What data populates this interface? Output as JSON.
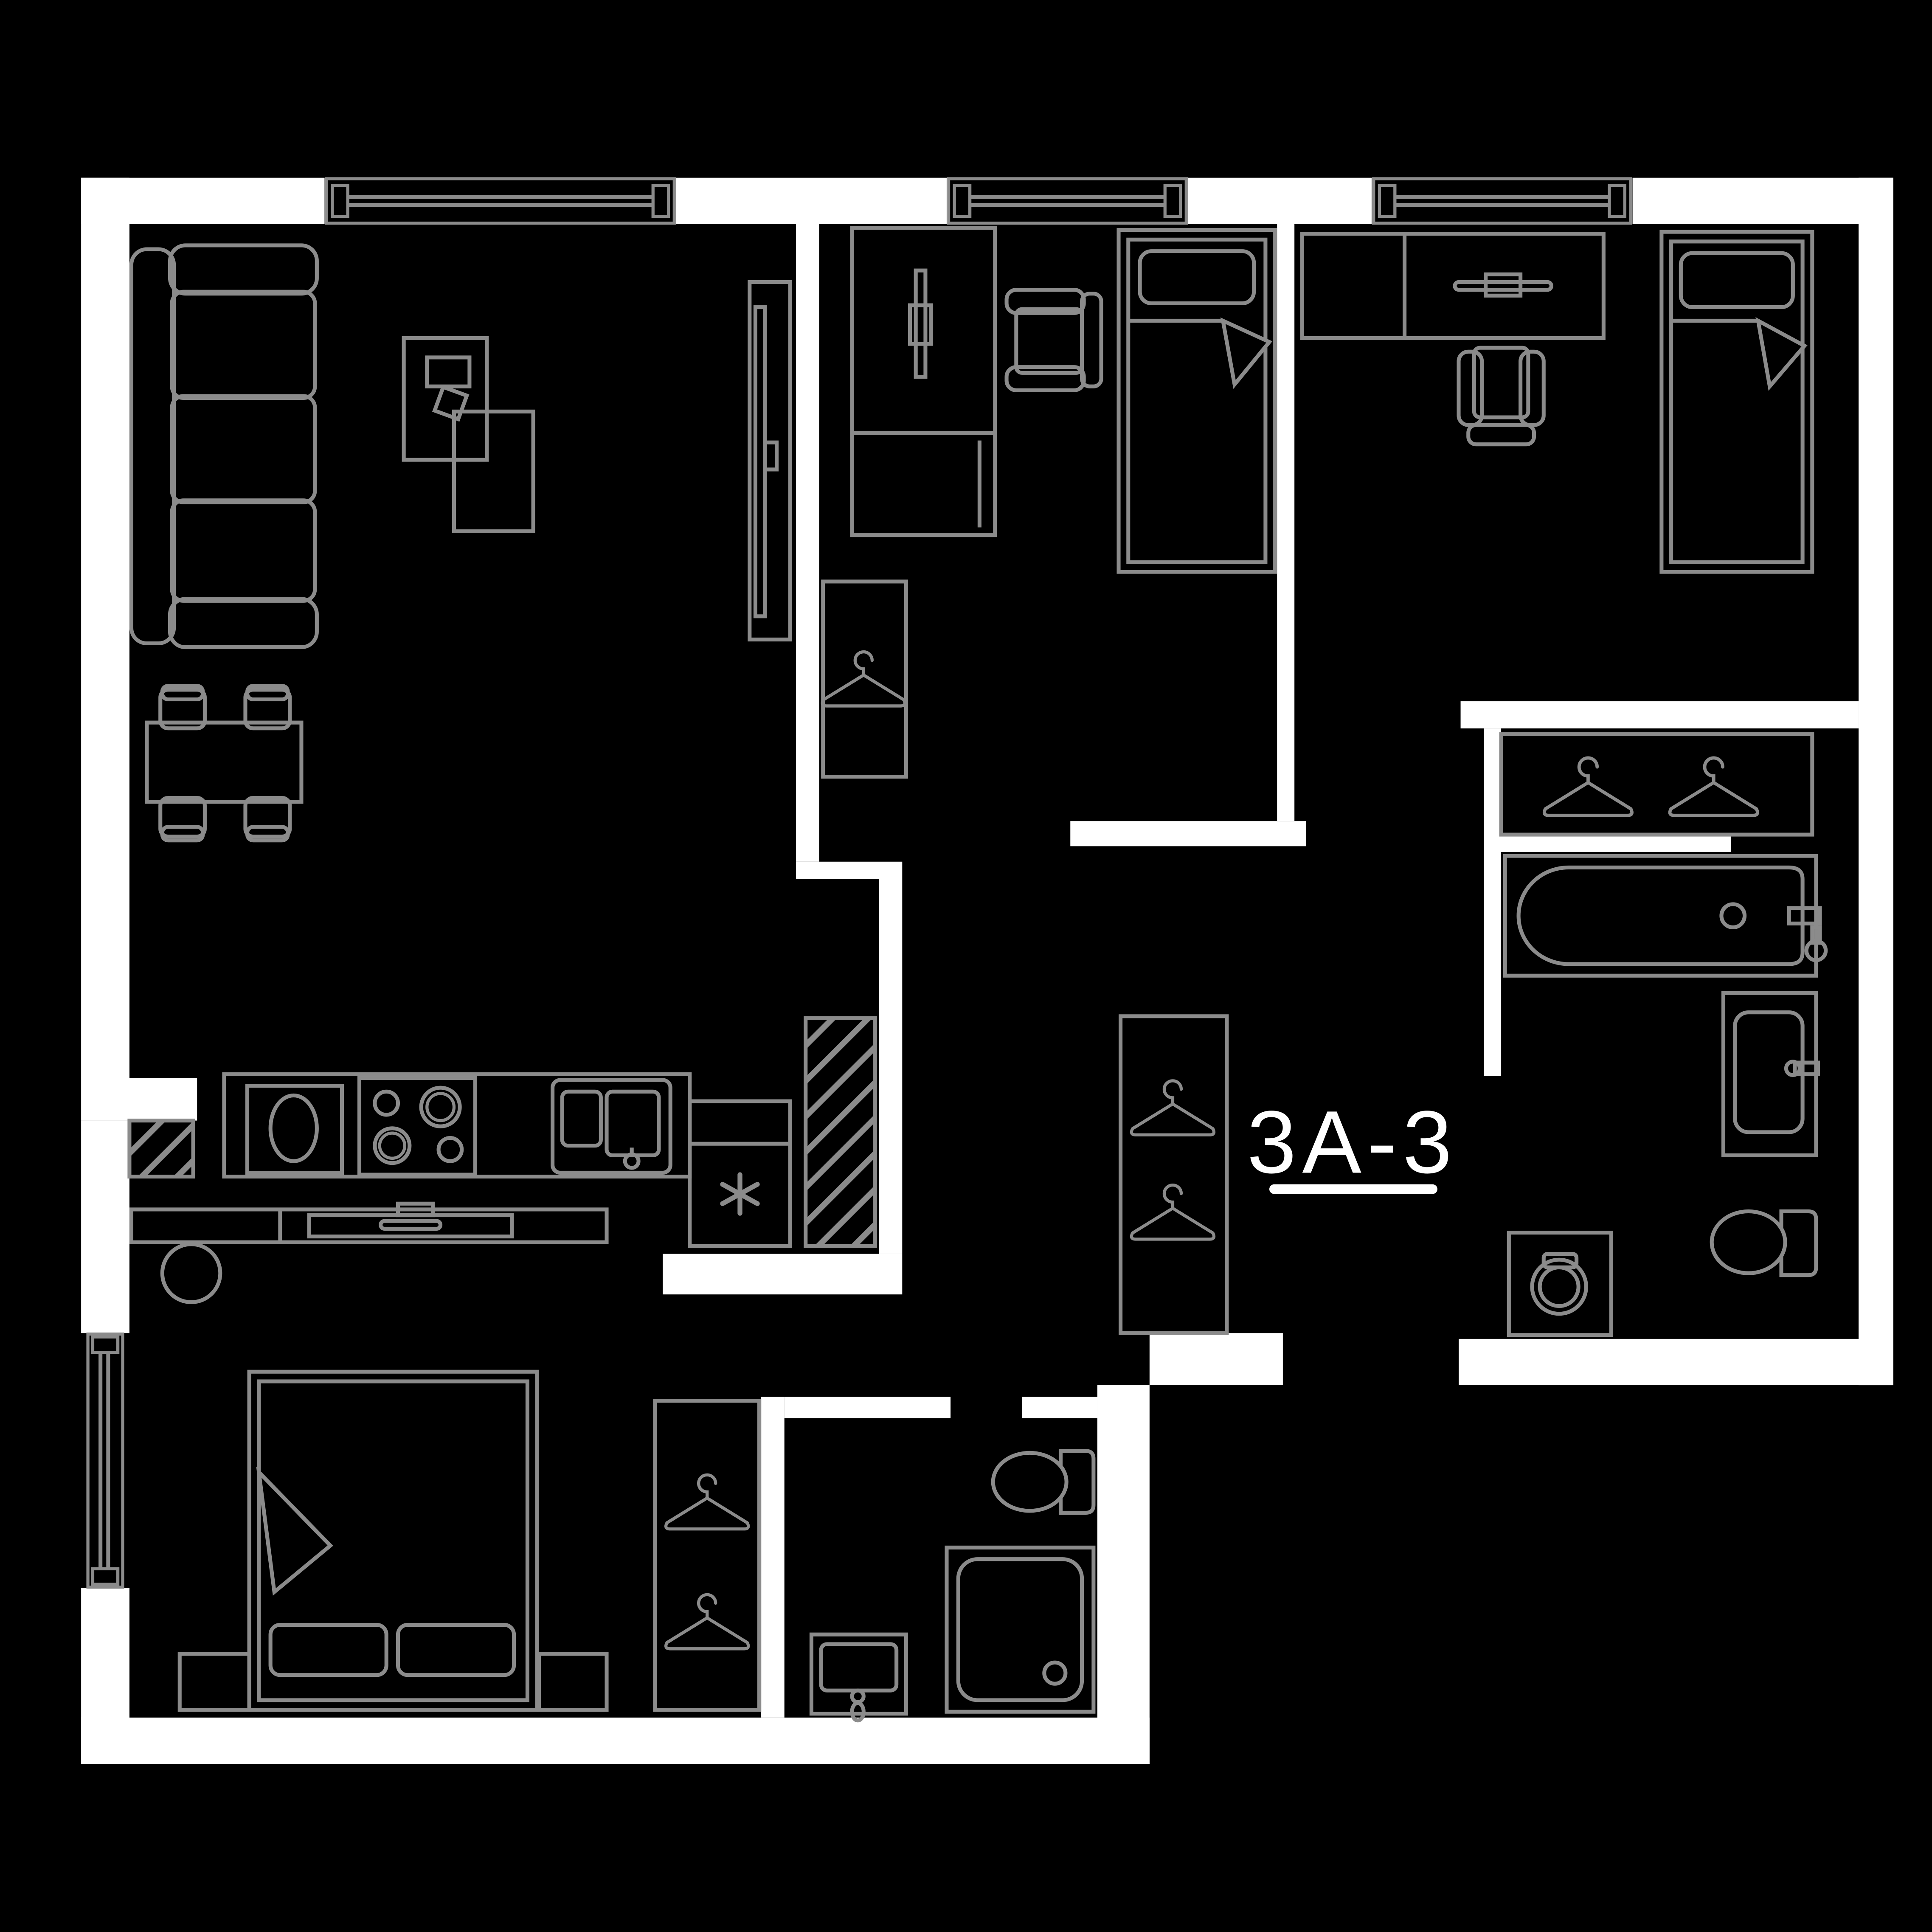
{
  "plan": {
    "unit_label": "3A-3",
    "colors": {
      "background": "#000000",
      "wall": "#ffffff",
      "furniture_line": "#8b8b8b",
      "label_text": "#ffffff"
    },
    "window_count": 4,
    "hanger_count": 7,
    "furniture_icons": [
      "sofa-icon",
      "coffee-table-icon",
      "side-table-icon",
      "tv-panel-icon",
      "dining-table-icon",
      "dining-chair-icon",
      "kitchen-counter-icon",
      "cooktop-icon",
      "kitchen-sink-icon",
      "fridge-snowflake-icon",
      "duct-hatch-icon",
      "sideboard-icon",
      "lamp-icon",
      "double-bed-icon",
      "nightstand-icon",
      "single-bed-icon",
      "desk-icon",
      "desk-chair-icon",
      "hanger-icon",
      "bathtub-icon",
      "vanity-sink-icon",
      "washing-machine-icon",
      "toilet-icon",
      "shower-icon",
      "bathroom-sink-icon",
      "window-icon"
    ]
  }
}
